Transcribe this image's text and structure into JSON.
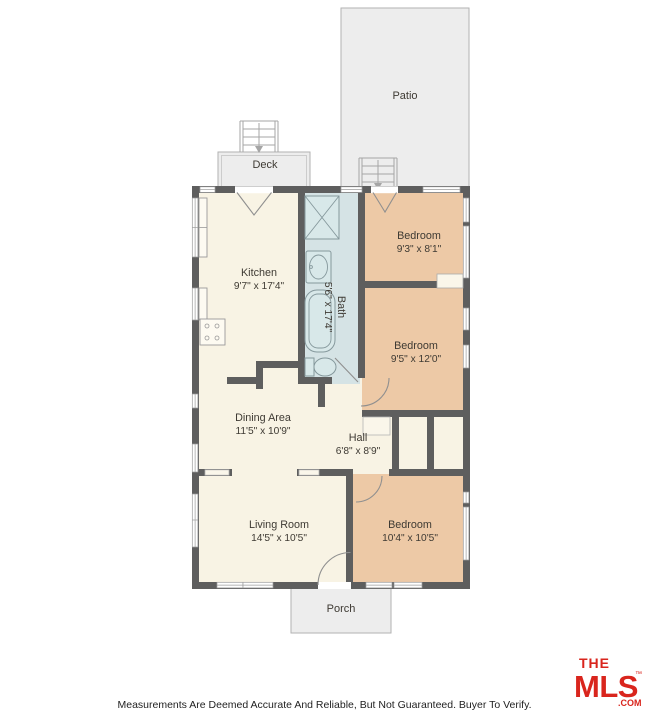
{
  "colors": {
    "bedroom_fill": "#edc9a6",
    "bath_fill": "#d5e3e5",
    "washer_fill": "#cfe0e2",
    "logo_red": "#d9251d"
  },
  "outdoor": {
    "patio_label": "Patio",
    "deck_label": "Deck",
    "porch_label": "Porch"
  },
  "rooms": {
    "kitchen": {
      "name": "Kitchen",
      "dims": "9'7\" x 17'4\""
    },
    "bath": {
      "name": "Bath",
      "dims": "5'6\" x 17'4\""
    },
    "bedroom1": {
      "name": "Bedroom",
      "dims": "9'3\" x 8'1\""
    },
    "bedroom2": {
      "name": "Bedroom",
      "dims": "9'5\" x 12'0\""
    },
    "dining": {
      "name": "Dining Area",
      "dims": "11'5\" x 10'9\""
    },
    "hall": {
      "name": "Hall",
      "dims": "6'8\" x 8'9\""
    },
    "living": {
      "name": "Living Room",
      "dims": "14'5\" x 10'5\""
    },
    "bedroom3": {
      "name": "Bedroom",
      "dims": "10'4\" x 10'5\""
    }
  },
  "logo": {
    "the": "THE",
    "mls": "MLS",
    "tm": "™",
    "com": ".COM"
  },
  "footer": {
    "disclaimer": "Measurements Are Deemed Accurate And Reliable, But Not Guaranteed. Buyer To Verify."
  }
}
